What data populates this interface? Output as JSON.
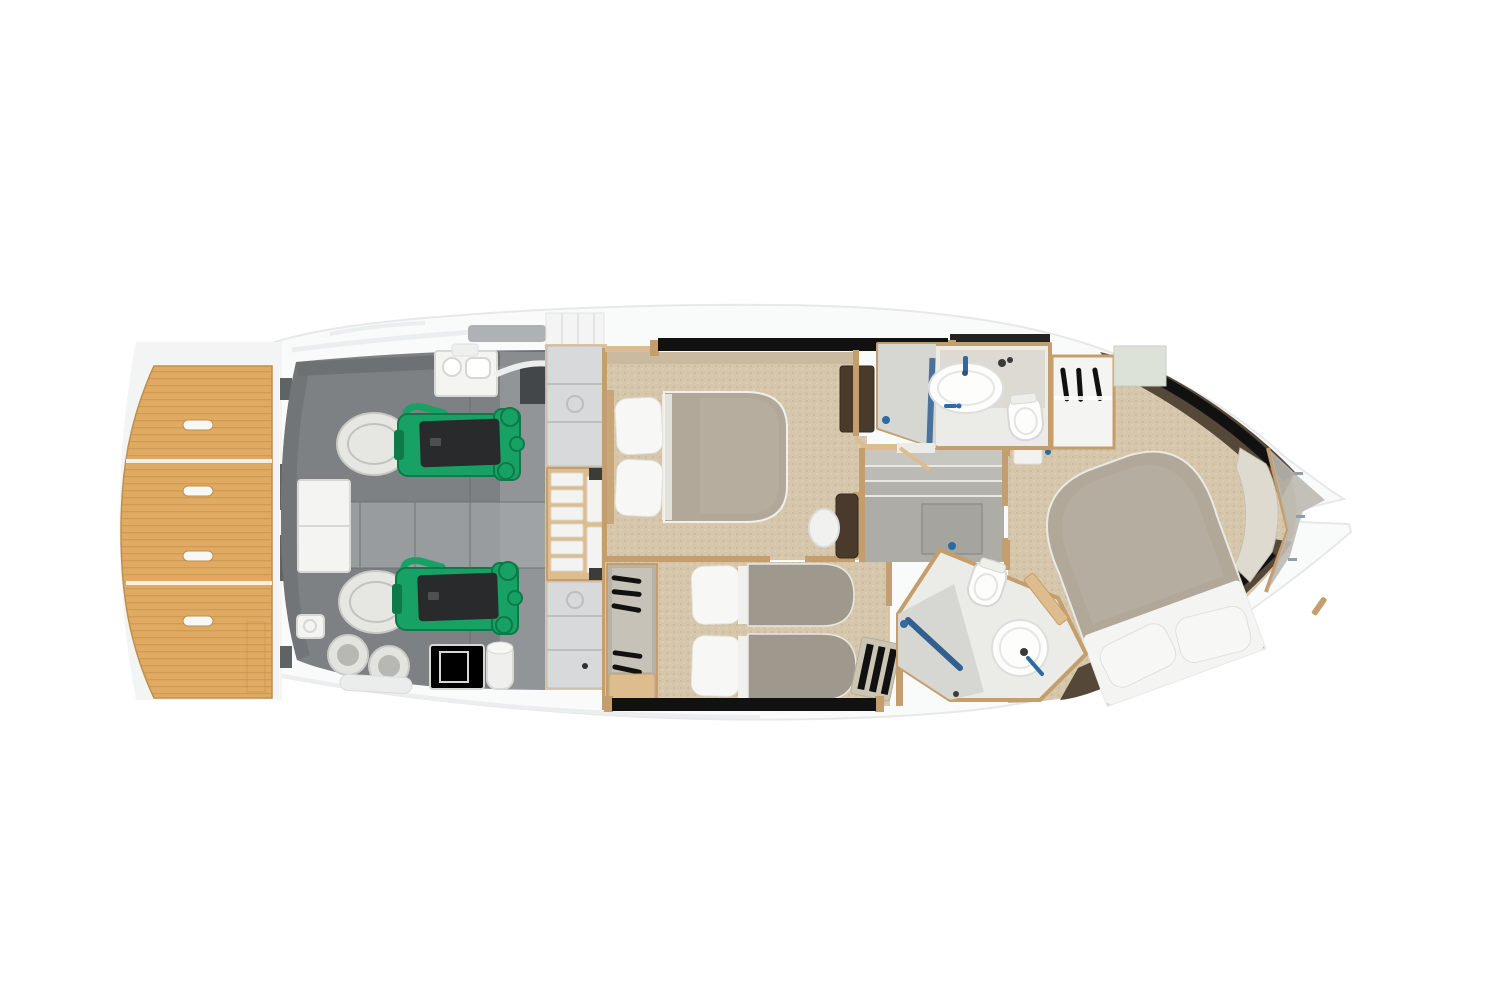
{
  "figure": {
    "type": "yacht-lower-deck-floor-plan",
    "view": "top-down",
    "background": "white",
    "bow_direction": "right",
    "stern_direction": "left"
  },
  "palette": {
    "bg": "#ffffff",
    "hull": "#f9fafa",
    "hull-line": "#e7e9e9",
    "hull-shadow": "#ebeeee",
    "teak": "#e0aa62",
    "teak-line": "#bf8f4c",
    "er-dark": "#7d8184",
    "er-floor": "#989c9f",
    "er-light": "#a6aaac",
    "er-shadow": "#6d7174",
    "green": "#18a164",
    "green-dark": "#0e7a49",
    "engine-black": "#282a2b",
    "white-fix": "#f4f4f2",
    "fix-line": "#d7d7d3",
    "panel": "#d8d9da",
    "panel-line": "#bcbec0",
    "wood": "#ddbc8d",
    "wood-dark": "#c49e6c",
    "carpet": "#d6c7ac",
    "carpet-dot": "#c6b596",
    "carpet-dot2": "#e3d6bd",
    "carpet-dark": "#cabba0",
    "duvet": "#b1a89a",
    "duvet-light": "#bab1a3",
    "twin-blanket": "#9e988d",
    "pillow": "#f7f7f5",
    "bath": "#ebebe8",
    "shower": "#d6d7d3",
    "glass": "#31608f",
    "faucet": "#2d6ca3",
    "dark-brown": "#493a2c",
    "hull-side": "#564838",
    "window": "#111111",
    "stair": "#aeaca7",
    "stair-light": "#c8c6c1",
    "sage": "#dde2d8",
    "bow-deck": "#bdb9b1",
    "gray-block": "#5e6366"
  },
  "regions": {
    "swim_platform": {
      "kind": "teak swim platform",
      "recessed_handles": 4,
      "plank_sections": 3
    },
    "engine_room": {
      "kind": "engine room",
      "engines": 2,
      "engine_color": "green",
      "mufflers": 2,
      "water_heaters": 2,
      "sink_unit": 1
    },
    "vip_cabin": {
      "kind": "midship double cabin",
      "bed": "double",
      "pillows": 2,
      "tv_cabinet": 1
    },
    "twin_cabin": {
      "kind": "twin guest cabin",
      "beds": 2,
      "wardrobe_hangers": 5,
      "bench": 1
    },
    "day_head": {
      "kind": "guest bathroom",
      "fixtures": [
        "shower",
        "oval-sink",
        "toilet"
      ]
    },
    "forward_wardrobe": {
      "kind": "wardrobe",
      "hangers": 3
    },
    "companionway": {
      "kind": "stairs and landing",
      "steps": 3,
      "floor_hatch": 1,
      "vanity_stool": 1
    },
    "master_head": {
      "kind": "master bathroom",
      "fixtures": [
        "shower",
        "round-sink",
        "toilet"
      ]
    },
    "master_cabin": {
      "kind": "forward master cabin",
      "bed": "double angled",
      "pillows": 2,
      "hull_windows": 2
    },
    "bow": {
      "kind": "anchor locker and bow deck"
    }
  }
}
